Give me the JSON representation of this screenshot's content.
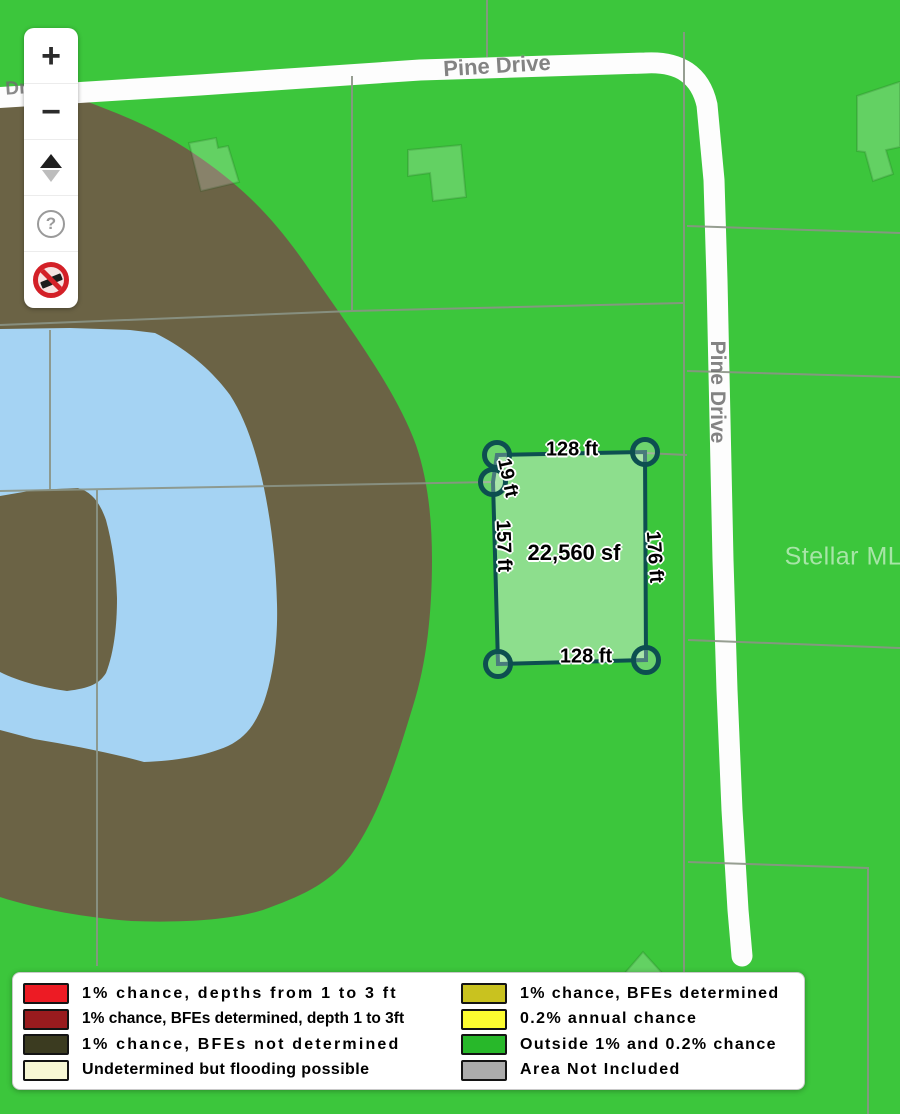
{
  "map": {
    "colors": {
      "green": "#3cc63c",
      "brown": "#6b6345",
      "blue": "#a5d3f3",
      "road": "#fdfdfd",
      "parcel_line": "#8b9486",
      "lot_outline": "#0d4f50",
      "lot_fill": "rgba(255,255,255,0.42)"
    },
    "roads": {
      "top_label": "Pine Drive",
      "side_label": "Pine Drive",
      "edge_label": "Dr"
    },
    "watermark": "Stellar MLS",
    "lot": {
      "area": "22,560 sf",
      "top_length": "128 ft",
      "bottom_length": "128 ft",
      "left_length": "157 ft",
      "right_length": "176 ft",
      "jog_length": "19 ft"
    }
  },
  "controls": {
    "zoom_in": "+",
    "zoom_out": "−",
    "help": "?"
  },
  "legend": {
    "left": [
      {
        "label": "1% chance, depths from 1 to 3 ft",
        "color": "#ed1b24"
      },
      {
        "label": "1% chance, BFEs determined, depth 1 to 3ft",
        "color": "#991b1e"
      },
      {
        "label": "1% chance, BFEs not determined",
        "color": "#3b3b20"
      },
      {
        "label": "Undetermined but flooding possible",
        "color": "#f7f7d4"
      }
    ],
    "right": [
      {
        "label": "1% chance, BFEs determined",
        "color": "#c9c21f"
      },
      {
        "label": "0.2% annual chance",
        "color": "#fcfc30"
      },
      {
        "label": "Outside 1% and 0.2% chance",
        "color": "#28b82a"
      },
      {
        "label": "Area Not Included",
        "color": "#ababab"
      }
    ]
  }
}
